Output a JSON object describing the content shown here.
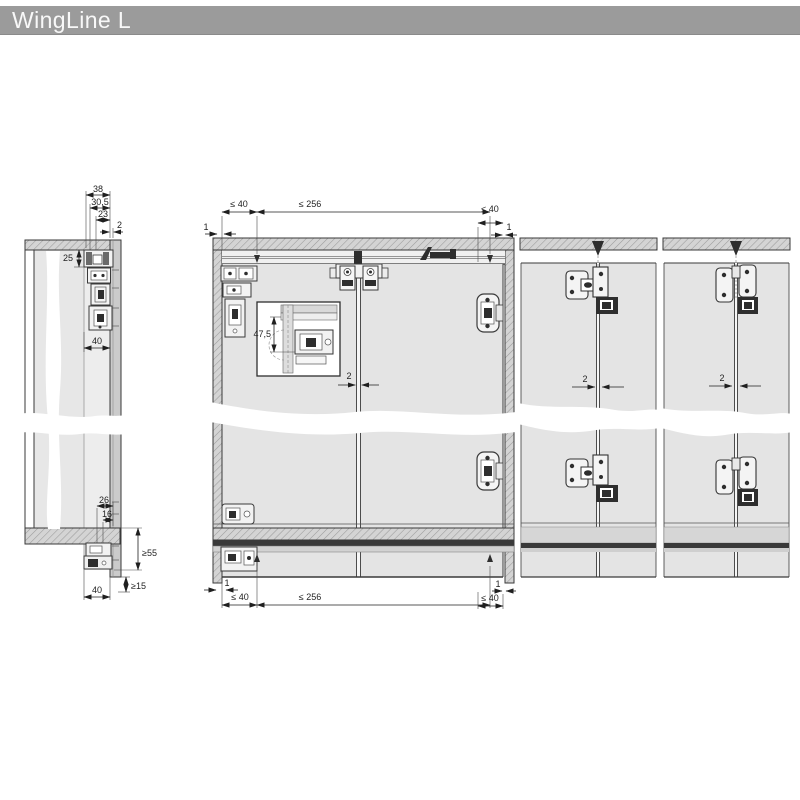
{
  "header": {
    "title": "WingLine L"
  },
  "colors": {
    "header_bg": "#9b9b9b",
    "drawing_line": "#3a3a3a",
    "door_fill": "#e4e4e4",
    "hatch_fill": "#d4d4d4",
    "dark_fitting": "#2e2e2e"
  },
  "drawing": {
    "side_section": {
      "dims": {
        "d38": "38",
        "d30_5": "30,5",
        "d23": "23",
        "d2": "2",
        "d25": "25",
        "d40_top": "40",
        "d26": "26",
        "d16": "16",
        "d55min": "≥55",
        "d15min": "≥15",
        "d40_bottom": "40"
      }
    },
    "front_view": {
      "dims": {
        "gap_top_left": "1",
        "offset_top_left": "≤ 40",
        "spacing_top": "≤ 256",
        "offset_top_right": "≤ 40",
        "gap_top_right": "1",
        "detail_height": "47,5",
        "joint_gap": "2",
        "gap_bottom_left": "1",
        "offset_bottom_left": "≤ 40",
        "spacing_bottom": "≤ 256",
        "gap_bottom_right": "1",
        "offset_bottom_right": "≤ 40"
      }
    },
    "door_pair_cross_hinge": {
      "dims": {
        "joint_gap": "2"
      }
    },
    "door_pair_flap_hinge": {
      "dims": {
        "joint_gap": "2"
      }
    }
  }
}
